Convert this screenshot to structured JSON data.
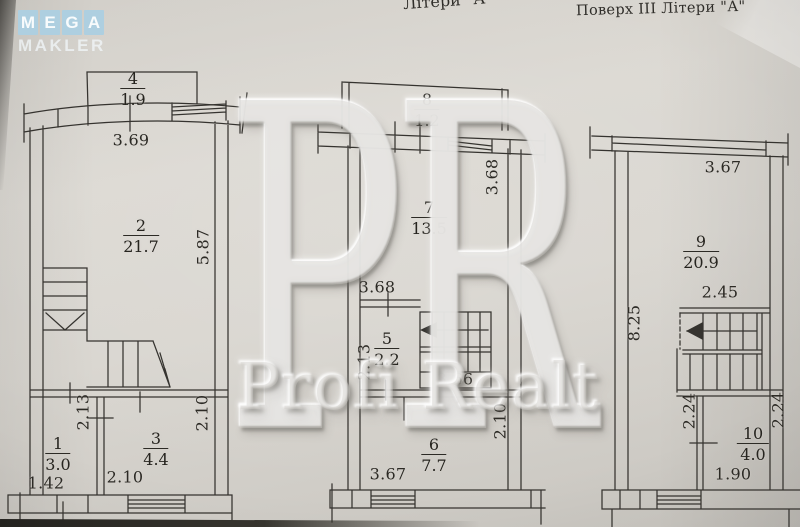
{
  "logo": {
    "tiles": [
      "M",
      "E",
      "G",
      "A"
    ],
    "subtitle": "MAKLER"
  },
  "header": {
    "title_left_partial": "Літери \"А\"",
    "title_right": "Поверх III Літери \"А\""
  },
  "watermark": {
    "monogram": "PR",
    "label": "Profi Realt"
  },
  "plans": {
    "left": {
      "rooms": [
        {
          "n": "4",
          "a": "1.9"
        },
        {
          "n": "2",
          "a": "21.7"
        },
        {
          "n": "1",
          "a": "3.0"
        },
        {
          "n": "3",
          "a": "4.4"
        }
      ],
      "dims": [
        "3.69",
        "5.87",
        "2.13",
        "2.10",
        "2.10",
        "1.42"
      ]
    },
    "middle": {
      "rooms": [
        {
          "n": "8",
          "a": "1.2"
        },
        {
          "n": "7",
          "a": "13.5"
        },
        {
          "n": "5",
          "a": "2.2"
        },
        {
          "n": "6",
          "a": "7.7"
        }
      ],
      "dims": [
        "3.68",
        "3.68",
        "2.13",
        "3.66",
        "2.10",
        "3.67"
      ]
    },
    "right": {
      "rooms": [
        {
          "n": "9",
          "a": "20.9"
        },
        {
          "n": "10",
          "a": "4.0"
        }
      ],
      "dims": [
        "3.67",
        "2.45",
        "8.25",
        "2.24",
        "2.24",
        "1.90"
      ]
    }
  },
  "colors": {
    "paper": "#d7d4ce",
    "line": "#35332f",
    "logo_tile": "#aecfe0",
    "logo_text": "#f8fbfc"
  }
}
